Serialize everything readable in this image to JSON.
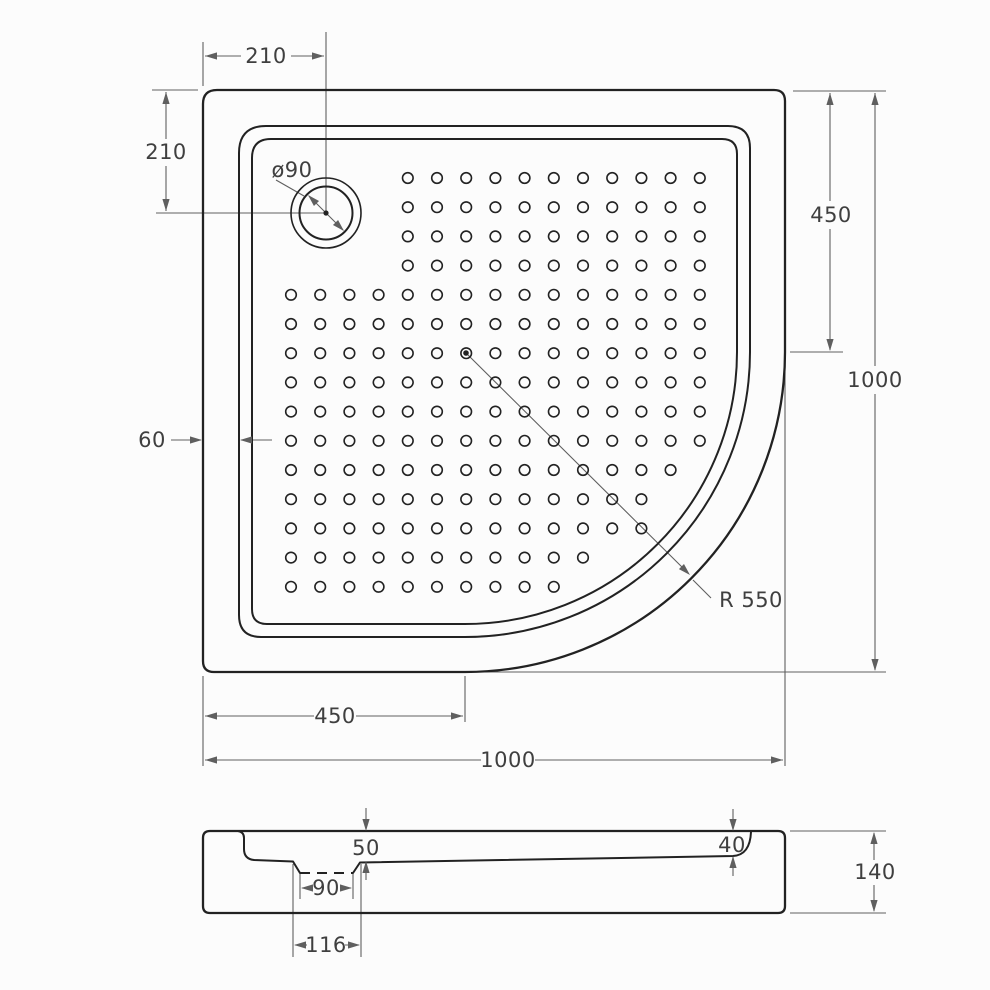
{
  "drawing": {
    "type": "technical-dimension-drawing",
    "subject": "quarter-round shower tray, top view and side profile",
    "colors": {
      "outline": "#222222",
      "dimension_lines": "#5f5f5f",
      "labels": "#3f3f3f",
      "background": "#fcfcfc"
    },
    "top_view": {
      "labels": {
        "drain_offset_x": "210",
        "drain_offset_y": "210",
        "drain_diameter": "ø90",
        "right_straight_edge": "450",
        "overall_depth": "1000",
        "rim_width": "60",
        "corner_radius": "R 550",
        "bottom_straight_edge": "450",
        "overall_width": "1000"
      }
    },
    "side_view": {
      "labels": {
        "drain_recess_depth": "50",
        "far_edge_depth": "40",
        "overall_height": "140",
        "recess_width_bottom": "90",
        "recess_width_top": "116"
      }
    }
  }
}
